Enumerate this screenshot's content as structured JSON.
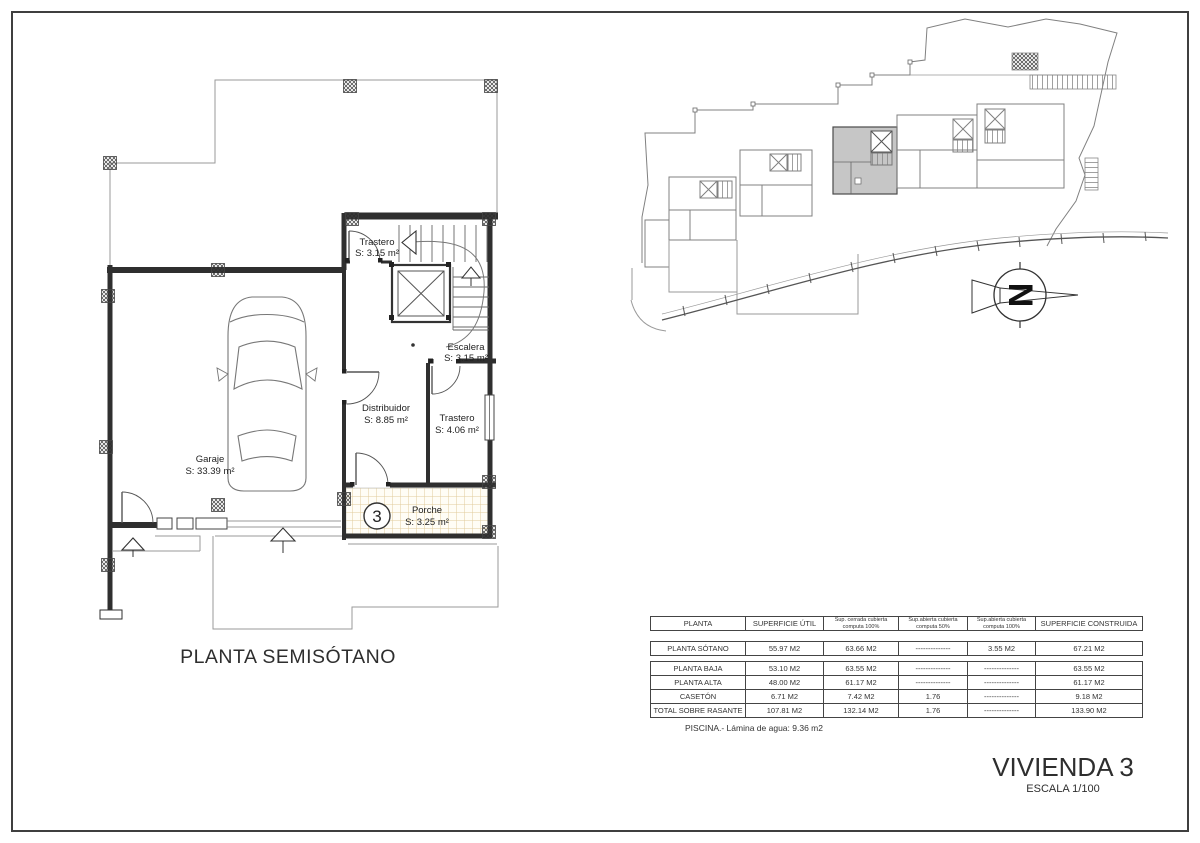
{
  "colors": {
    "line": "#3a3a3a",
    "site_line": "#808080",
    "highlight_fill": "#c6c6c6",
    "tile_line": "#e0cc9c"
  },
  "floor_plan": {
    "title": "PLANTA SEMISÓTANO",
    "unit_number": "3",
    "rooms": [
      {
        "name": "Trastero",
        "area": "S: 3.15 m²"
      },
      {
        "name": "Escalera",
        "area": "S: 3.15 m²"
      },
      {
        "name": "Distribuidor",
        "area": "S: 8.85 m²"
      },
      {
        "name": "Trastero",
        "area": "S: 4.06 m²"
      },
      {
        "name": "Garaje",
        "area": "S: 33.39 m²"
      },
      {
        "name": "Porche",
        "area": "S: 3.25 m²"
      }
    ]
  },
  "site_plan": {
    "north_label": "N"
  },
  "areas_table": {
    "headers": [
      {
        "line1": "PLANTA",
        "line2": ""
      },
      {
        "line1": "SUPERFICIE ÚTIL",
        "line2": ""
      },
      {
        "line1": "Sup. cerrada cubierta",
        "line2": "computa 100%"
      },
      {
        "line1": "Sup.abierta cubierta",
        "line2": "computa 50%"
      },
      {
        "line1": "Sup.abierta cubierta",
        "line2": "computa 100%"
      },
      {
        "line1": "SUPERFICIE CONSTRUIDA",
        "line2": ""
      }
    ],
    "rows": [
      {
        "label": "PLANTA SÓTANO",
        "values": [
          "55.97 M2",
          "63.66 M2",
          "--------------",
          "3.55 M2",
          "67.21 M2"
        ]
      },
      {
        "label": "PLANTA BAJA",
        "values": [
          "53.10 M2",
          "63.55 M2",
          "--------------",
          "--------------",
          "63.55 M2"
        ]
      },
      {
        "label": "PLANTA ALTA",
        "values": [
          "48.00 M2",
          "61.17 M2",
          "--------------",
          "--------------",
          "61.17 M2"
        ]
      },
      {
        "label": "CASETÓN",
        "values": [
          "6.71 M2",
          "7.42 M2",
          "1.76",
          "--------------",
          "9.18 M2"
        ]
      },
      {
        "label": "TOTAL SOBRE RASANTE",
        "values": [
          "107.81 M2",
          "132.14 M2",
          "1.76",
          "--------------",
          "133.90 M2"
        ]
      }
    ],
    "note": "PISCINA.- Lámina de agua: 9.36 m2"
  },
  "title_block": {
    "title": "VIVIENDA 3",
    "scale": "ESCALA 1/100"
  }
}
